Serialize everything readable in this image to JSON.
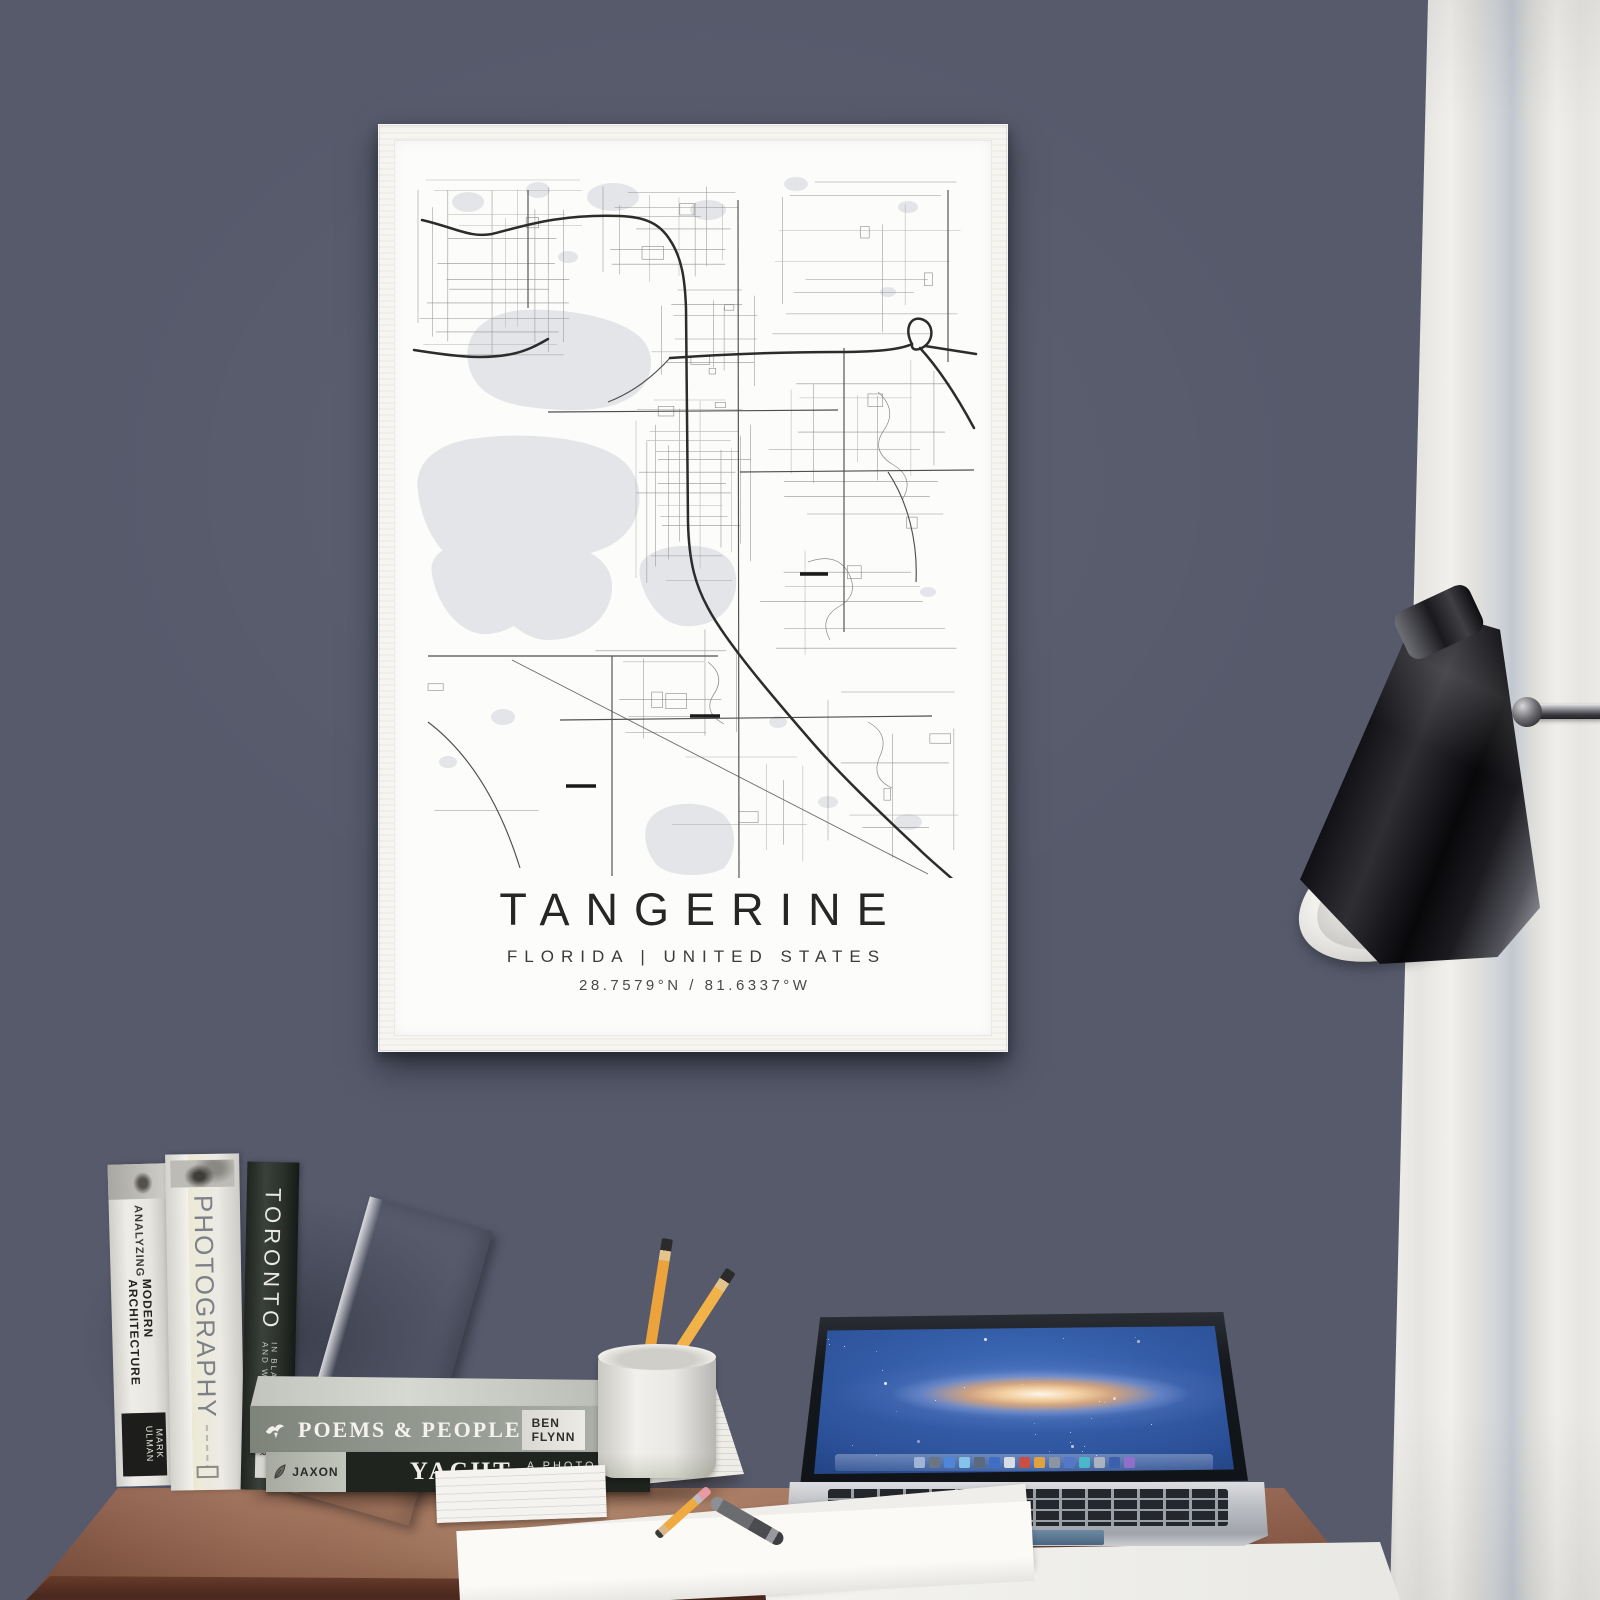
{
  "poster": {
    "title": "TANGERINE",
    "subtitle": "FLORIDA | UNITED STATES",
    "coordinates": "28.7579°N / 81.6337°W"
  },
  "books": {
    "architecture": {
      "title_line1": "ANALYZING",
      "title_line2": "MODERN ARCHITECTURE",
      "author": "MARK ULMAN"
    },
    "photography": {
      "title": "PHOTOGRAPHY"
    },
    "toronto": {
      "title": "TORONTO",
      "subtitle": "IN BLACK AND WHITE",
      "author": "STUART TYLER"
    },
    "poems": {
      "title": "POEMS & PEOPLE",
      "author": "BEN FLYNN"
    },
    "yacht": {
      "title": "YACHT",
      "subtitle": "A PHOTO JOURNAL",
      "label": "JAXON"
    }
  },
  "laptop": {
    "dock_colors": [
      "#9fb4d6",
      "#6b7684",
      "#4f86d8",
      "#86c3e8",
      "#5a6b7d",
      "#3f6fc4",
      "#d8dde5",
      "#c94f44",
      "#e0a23e",
      "#8b95a3",
      "#5577c9",
      "#49b8c8",
      "#aab3bf",
      "#3c5fae",
      "#8e6fc9"
    ]
  },
  "colors": {
    "wall": "#565a6b",
    "desk": "#96654c",
    "curtain": "#edece8",
    "frame": "#f6f5f1",
    "map_lake": "#e4e5e8",
    "map_road_major": "#2c2c2c",
    "map_road_minor": "#949494"
  }
}
